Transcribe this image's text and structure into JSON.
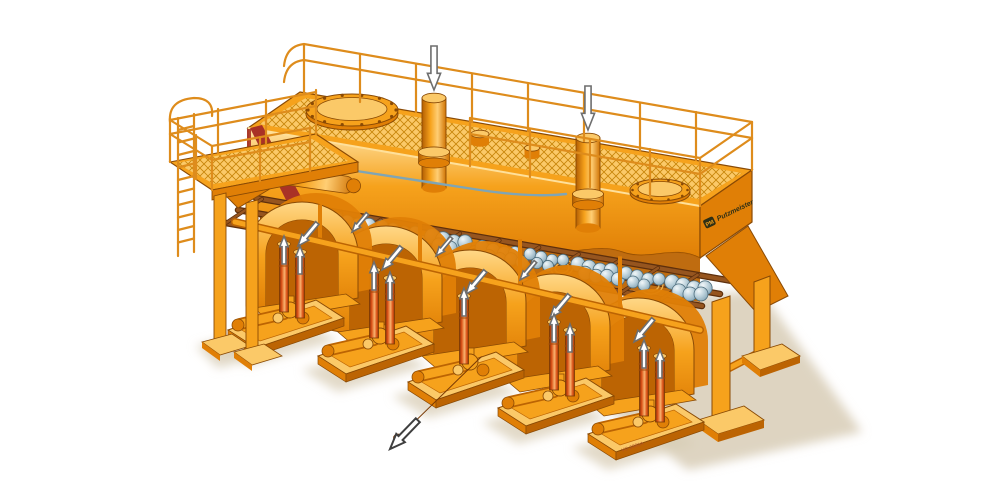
{
  "illustration": {
    "description": "Cutaway illustration of an elevated orange industrial processing machine: top platform with mesh grating and guard railings, two feed inlet pipes, two bolted manhole covers, internal inclined screen grate carrying clusters of grey-blue rocks, five arched pump units on skid bases with red riser pipes, one diagonal discharge pipe, access ladder and support legs"
  },
  "brand": {
    "logo_text": "PM",
    "name_text": "Putzmeister"
  },
  "marking": {
    "drawing_number": "VG 0981A"
  },
  "colors": {
    "background": "#ffffff",
    "machine_orange": "#F6A21C",
    "machine_orange_light": "#FBC968",
    "machine_orange_lighter": "#FFE3A3",
    "machine_orange_dark": "#E07F06",
    "machine_orange_deep": "#BC6403",
    "outline_brown": "#8A4A05",
    "cut_edge_red": "#A93226",
    "grate_brown": "#96551F",
    "grate_brown_dark": "#5E2F0C",
    "stone_blue": "#BDD2DC",
    "stone_blue_dark": "#7E9FB0",
    "stone_outline": "#4E6E7E",
    "pipe_red": "#DD5519",
    "pipe_red_light": "#F8B36F",
    "arrow_white": "#FFFFFF",
    "arrow_outline": "#6E6E6E",
    "shadow_beige": "#D8CDB6",
    "mesh_gold": "#C8860B",
    "railing_orange": "#DE8C1C",
    "hose_blue": "#7FA5B5",
    "spring_gold": "#ECAF4C"
  },
  "flow_arrows": [
    {
      "name": "feed-inlet-arrow-1",
      "x": 434,
      "y": 90,
      "angle": 180,
      "len": 44,
      "style": "solid"
    },
    {
      "name": "feed-inlet-arrow-2",
      "x": 588,
      "y": 130,
      "angle": 180,
      "len": 44,
      "style": "solid"
    },
    {
      "name": "hood-flow-arrow-1",
      "x": 298,
      "y": 246,
      "angle": 220,
      "len": 30,
      "style": "solid"
    },
    {
      "name": "hood-flow-arrow-2",
      "x": 382,
      "y": 270,
      "angle": 220,
      "len": 30,
      "style": "solid"
    },
    {
      "name": "hood-flow-arrow-3",
      "x": 466,
      "y": 294,
      "angle": 220,
      "len": 30,
      "style": "solid"
    },
    {
      "name": "hood-flow-arrow-4",
      "x": 550,
      "y": 318,
      "angle": 220,
      "len": 30,
      "style": "solid"
    },
    {
      "name": "hood-flow-arrow-5",
      "x": 634,
      "y": 342,
      "angle": 220,
      "len": 30,
      "style": "solid"
    },
    {
      "name": "rear-hood-arrow-1",
      "x": 352,
      "y": 232,
      "angle": 220,
      "len": 24,
      "style": "solid"
    },
    {
      "name": "rear-hood-arrow-2",
      "x": 436,
      "y": 256,
      "angle": 220,
      "len": 24,
      "style": "solid"
    },
    {
      "name": "rear-hood-arrow-3",
      "x": 520,
      "y": 280,
      "angle": 220,
      "len": 24,
      "style": "solid"
    },
    {
      "name": "riser-arrow-1a",
      "x": 284,
      "y": 236,
      "angle": 0,
      "len": 28,
      "style": "solid"
    },
    {
      "name": "riser-arrow-1b",
      "x": 300,
      "y": 246,
      "angle": 0,
      "len": 28,
      "style": "solid"
    },
    {
      "name": "riser-arrow-2a",
      "x": 374,
      "y": 262,
      "angle": 0,
      "len": 28,
      "style": "solid"
    },
    {
      "name": "riser-arrow-2b",
      "x": 390,
      "y": 272,
      "angle": 0,
      "len": 28,
      "style": "solid"
    },
    {
      "name": "riser-arrow-3",
      "x": 464,
      "y": 288,
      "angle": 0,
      "len": 28,
      "style": "solid"
    },
    {
      "name": "riser-arrow-4a",
      "x": 554,
      "y": 314,
      "angle": 0,
      "len": 28,
      "style": "solid"
    },
    {
      "name": "riser-arrow-4b",
      "x": 570,
      "y": 324,
      "angle": 0,
      "len": 28,
      "style": "solid"
    },
    {
      "name": "riser-arrow-5a",
      "x": 644,
      "y": 340,
      "angle": 0,
      "len": 28,
      "style": "solid"
    },
    {
      "name": "riser-arrow-5b",
      "x": 660,
      "y": 350,
      "angle": 0,
      "len": 28,
      "style": "solid"
    },
    {
      "name": "discharge-arrow",
      "x": 390,
      "y": 449,
      "angle": 224,
      "len": 40,
      "style": "outline"
    }
  ],
  "material_clusters": [
    {
      "x": 305,
      "y": 214,
      "count": 7
    },
    {
      "x": 352,
      "y": 224,
      "count": 5
    },
    {
      "x": 398,
      "y": 231,
      "count": 8
    },
    {
      "x": 448,
      "y": 241,
      "count": 6
    },
    {
      "x": 498,
      "y": 252,
      "count": 9
    },
    {
      "x": 546,
      "y": 259,
      "count": 6
    },
    {
      "x": 594,
      "y": 269,
      "count": 8
    },
    {
      "x": 642,
      "y": 278,
      "count": 6
    },
    {
      "x": 688,
      "y": 287,
      "count": 7
    }
  ]
}
